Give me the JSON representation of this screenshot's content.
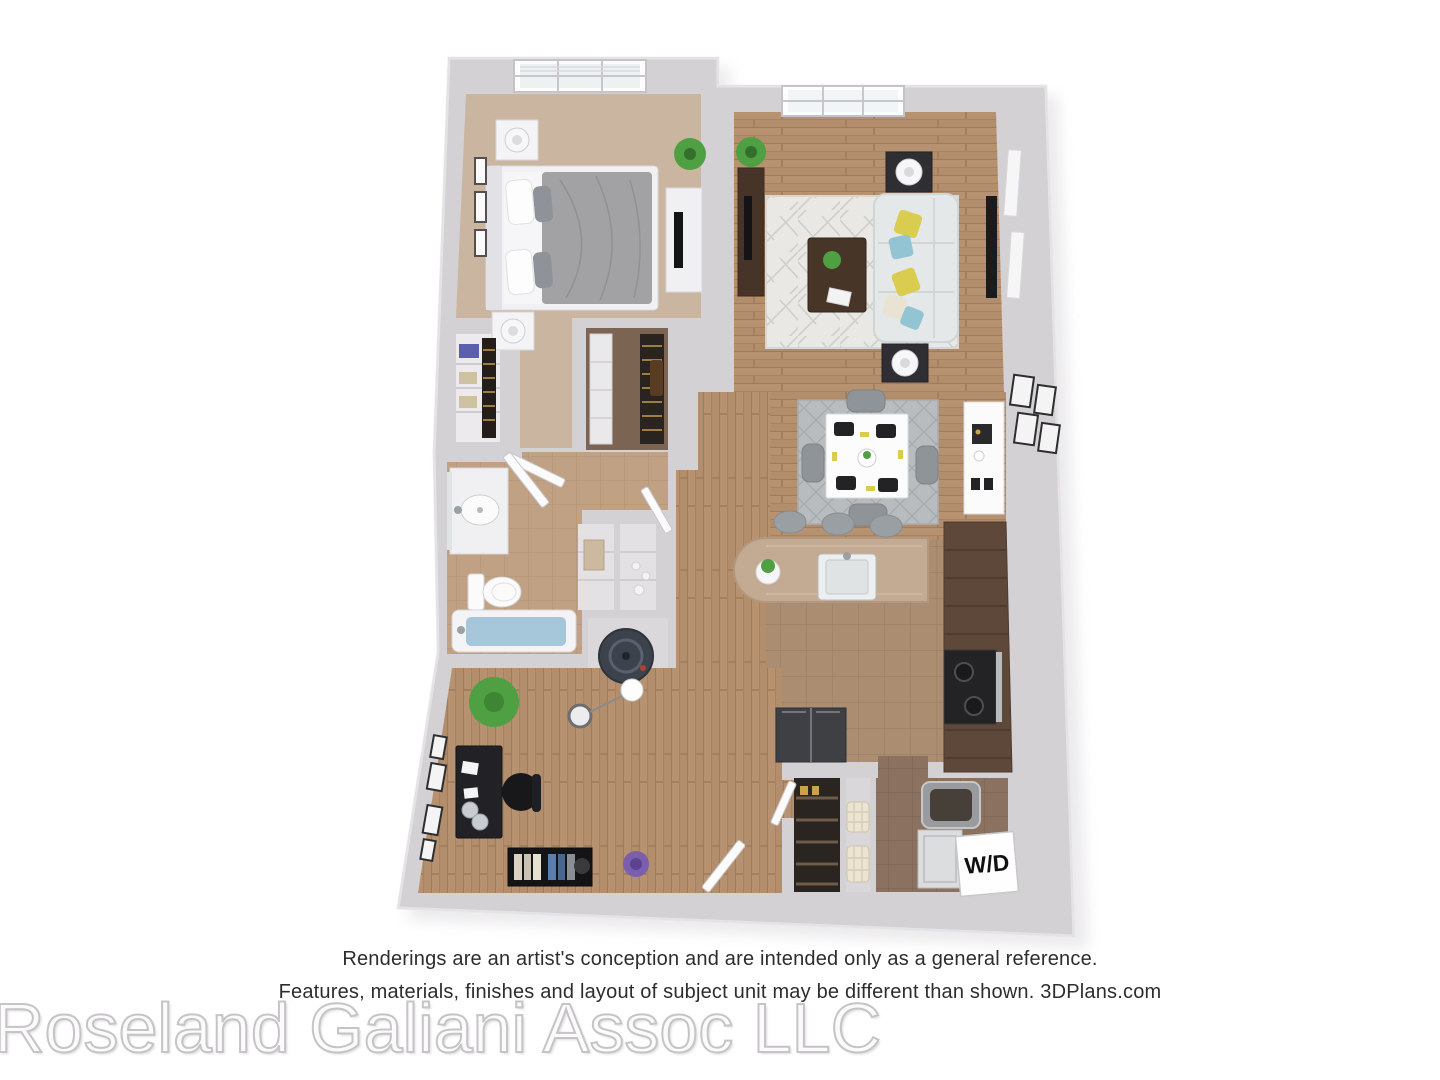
{
  "footer": {
    "disclaimer_line1": "Renderings are an artist's conception and are intended only as a general reference.",
    "disclaimer_line2": "Features, materials, finishes and layout of subject unit may be different than shown. 3DPlans.com",
    "watermark": "Roseland Galiani Assoc LLC"
  },
  "floor_plan": {
    "type": "3d-apartment-floor-plan-rendering",
    "labels": {
      "washer_dryer": "W/D"
    },
    "rooms": [
      "bedroom",
      "reach-in-closet",
      "walk-in-closet",
      "bathroom",
      "linen-closet",
      "water-heater-closet",
      "living-room",
      "dining-area",
      "kitchen",
      "breakfast-bar",
      "hallway",
      "office-den",
      "foyer",
      "pantry",
      "laundry-room"
    ],
    "palette": {
      "wall": "#d4d1d5",
      "wall_edge": "#c7c4c8",
      "wall_highlight": "#eceaee",
      "shadow": "#dbd9dc",
      "carpet_bedroom": "#c9b5a0",
      "closet_carpet": "#7c6452",
      "wood": "#b38e6c",
      "tile_bath": "#c0a184",
      "tile_kitchen": "#ab8d71",
      "tile_laundry": "#8a7160",
      "rug_living": "#eae8e4",
      "rug_dining": "#b9bcbf",
      "sofa": "#e5e8e8",
      "bed_duvet": "#a2a2a4",
      "pillow_yellow": "#d9cc4e",
      "pillow_blue": "#92c4d4",
      "dark_wood": "#473528",
      "cabinets": "#5d483a",
      "counter": "#c3ab93",
      "appliance_dark": "#232326",
      "fridge": "#3f4044",
      "tub_water": "#a5c7d9",
      "water_heater": "#3d434d",
      "plant_green": "#4f9f43",
      "plant_purple": "#7a5fae",
      "fixture_white": "#f4f3f5"
    }
  }
}
